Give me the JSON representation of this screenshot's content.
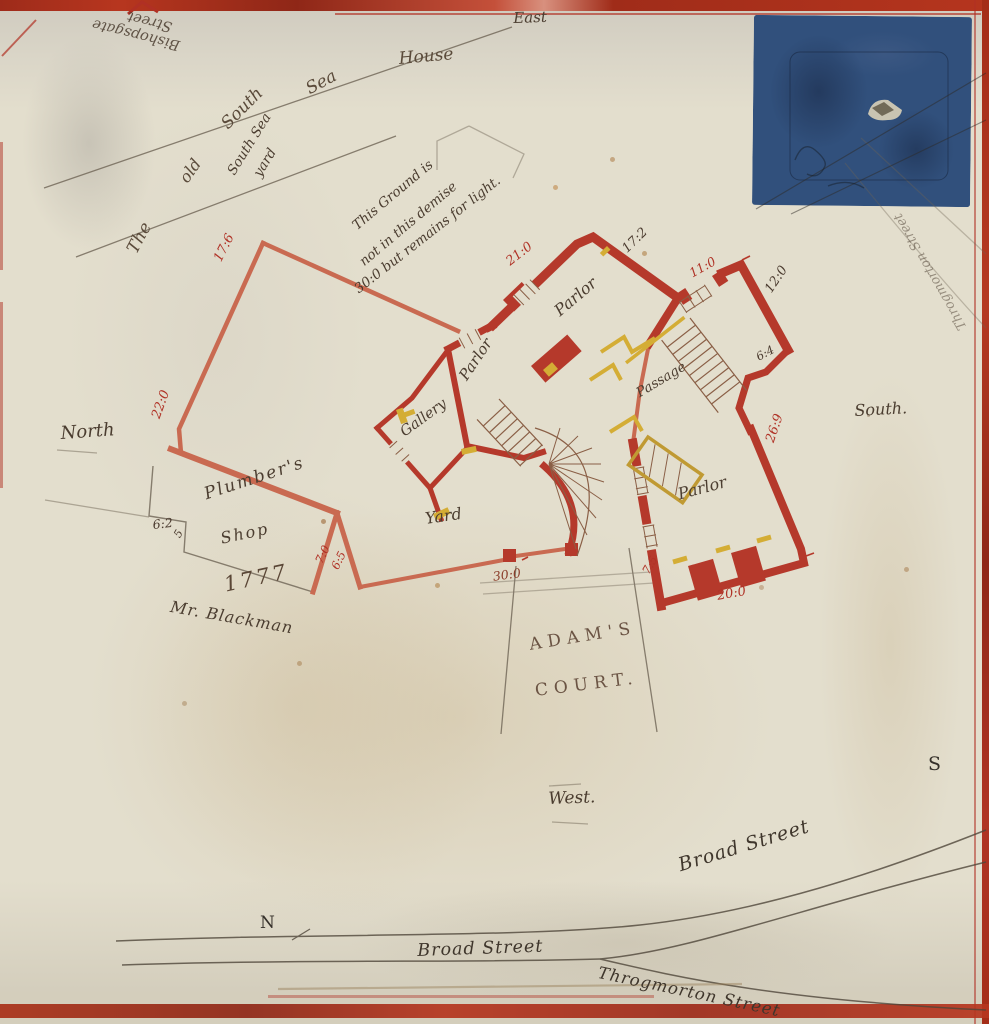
{
  "compass": {
    "east": "East",
    "north": "North",
    "south": "South.",
    "west": "West.",
    "n": "N",
    "s": "S"
  },
  "title": {
    "w1": "The",
    "w2": "old",
    "w3": "South",
    "w4": "Sea",
    "w5": "House"
  },
  "yard_label": {
    "l1": "South Sea",
    "l2": "yard"
  },
  "note": {
    "l1": "This Ground is",
    "l2": "not in this demise",
    "l3": "30:0 but remains for light."
  },
  "rooms": {
    "parlor_top": "Parlor",
    "parlor_left": "Parlor",
    "parlor_right": "Parlor",
    "gallery": "Gallery",
    "passage": "Passage",
    "yard": "Yard",
    "plumbers_line1": "Plumber's",
    "plumbers_line2": "Shop"
  },
  "names": {
    "blackman": "Mr. Blackman",
    "adams_line1": "ADAM'S",
    "adams_line2": "COURT.",
    "year": "1777"
  },
  "streets": {
    "bishopsgate_line1": "Bishopsgate",
    "bishopsgate_line2": "Street",
    "broad_diagonal": "Broad Street",
    "broad_horizontal": "Broad Street",
    "throgmorton": "Throgmorton Street",
    "throgmorton_side": "Throgmorton Street"
  },
  "dimensions": {
    "d17_6": "17:6",
    "d22_0": "22:0",
    "d21_0": "21:0",
    "d17_2": "17:2",
    "d11_0": "11:0",
    "d12_0": "12:0",
    "d6_4": "6:4",
    "d26_9": "26:9",
    "d20_0": "20:0",
    "d7_5": "7:5",
    "d7_0": "7:0",
    "d6_5": "6:5",
    "d6_2": "6:2",
    "d6_2_frac": "5",
    "d30_0": "30:0"
  },
  "colors": {
    "paper": "#e3decd",
    "wall_red": "#b5392b",
    "wall_light": "#c96a51",
    "fixture_yellow": "#d4ad35",
    "ink": "#4b3d30",
    "red_ink": "#b03226",
    "pencil": "#6f6455",
    "patch_blue": "#31507c",
    "border_red": "#a93018"
  }
}
